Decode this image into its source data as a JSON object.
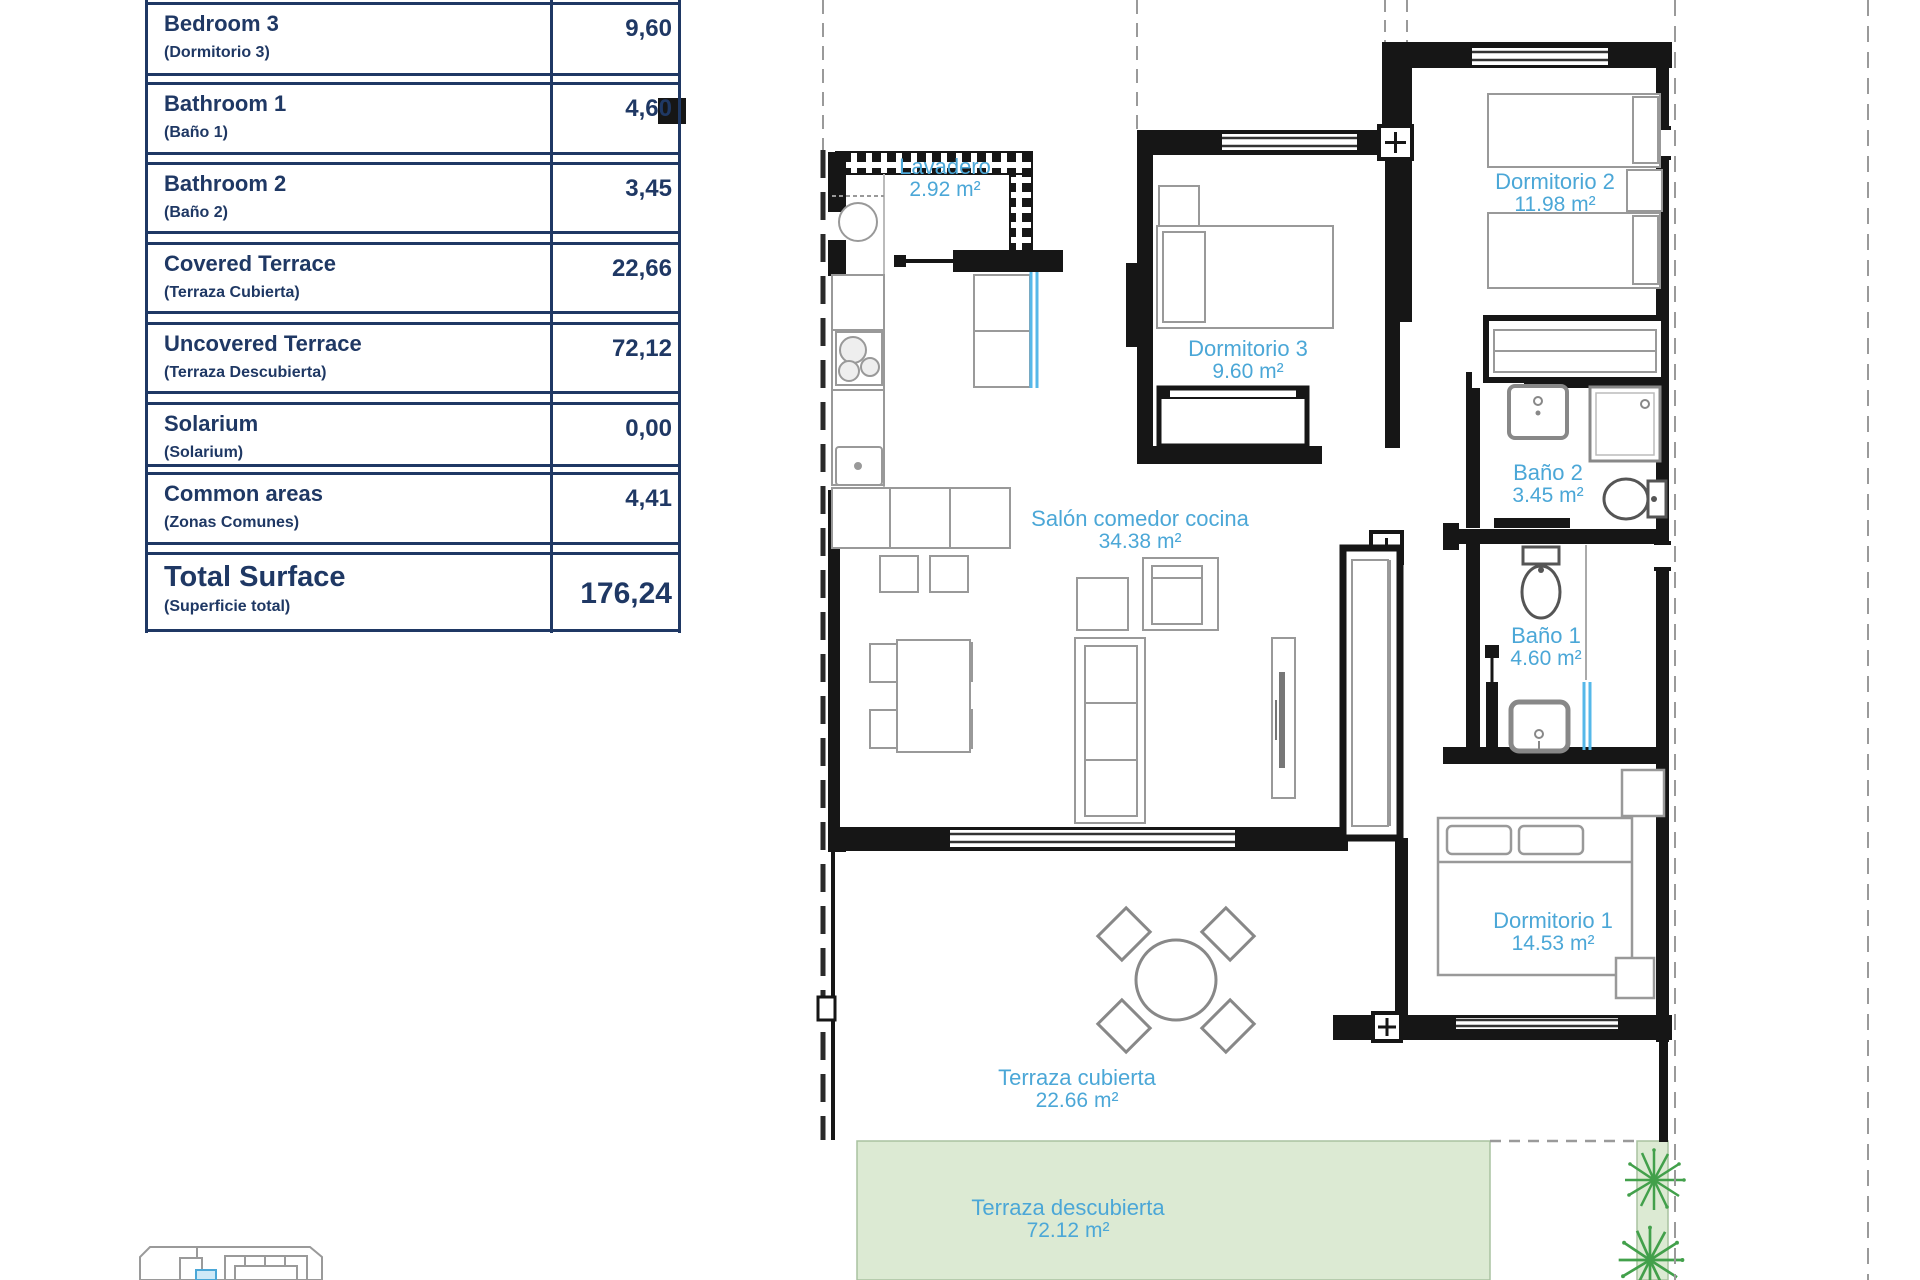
{
  "surface_table": {
    "rows": [
      {
        "name_en": "Bedroom 3",
        "name_es": "(Dormitorio 3)",
        "value": "9,60"
      },
      {
        "name_en": "Bathroom 1",
        "name_es": "(Baño 1)",
        "value": "4,60"
      },
      {
        "name_en": "Bathroom 2",
        "name_es": "(Baño 2)",
        "value": "3,45"
      },
      {
        "name_en": "Covered Terrace",
        "name_es": "(Terraza Cubierta)",
        "value": "22,66"
      },
      {
        "name_en": "Uncovered Terrace",
        "name_es": "(Terraza Descubierta)",
        "value": "72,12"
      },
      {
        "name_en": "Solarium",
        "name_es": "(Solarium)",
        "value": "0,00"
      },
      {
        "name_en": "Common areas",
        "name_es": "(Zonas Comunes)",
        "value": "4,41"
      }
    ],
    "total": {
      "name_en": "Total Surface",
      "name_es": "(Superficie total)",
      "value": "176,24"
    }
  },
  "floor_plan": {
    "rooms": [
      {
        "id": "lavadero",
        "label": "Lavadero",
        "area": "2.92 m²"
      },
      {
        "id": "dormitorio-2",
        "label": "Dormitorio 2",
        "area": "11.98 m²"
      },
      {
        "id": "dormitorio-3",
        "label": "Dormitorio 3",
        "area": "9.60 m²"
      },
      {
        "id": "bano-2",
        "label": "Baño 2",
        "area": "3.45 m²"
      },
      {
        "id": "salon-comedor-cocina",
        "label": "Salón comedor cocina",
        "area": "34.38 m²"
      },
      {
        "id": "bano-1",
        "label": "Baño 1",
        "area": "4.60 m²"
      },
      {
        "id": "dormitorio-1",
        "label": "Dormitorio 1",
        "area": "14.53 m²"
      },
      {
        "id": "terraza-cubierta",
        "label": "Terraza cubierta",
        "area": "22.66 m²"
      },
      {
        "id": "terraza-descubierta",
        "label": "Terraza descubierta",
        "area": "72.12 m²"
      }
    ],
    "colors": {
      "label_blue": "#4BA7D7",
      "wall_black": "#161616",
      "terrace_green": "#DCEAD3",
      "plant_green": "#42A04B",
      "door_blue": "#56B8E9",
      "table_navy": "#1F3864"
    }
  }
}
